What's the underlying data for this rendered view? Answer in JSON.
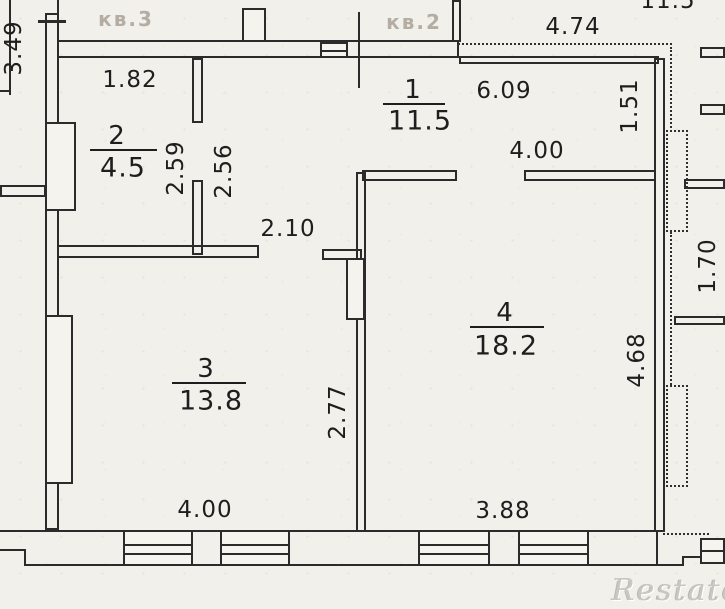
{
  "rooms": [
    {
      "number": "1",
      "area": "11.5"
    },
    {
      "number": "2",
      "area": "4.5"
    },
    {
      "number": "3",
      "area": "13.8"
    },
    {
      "number": "4",
      "area": "18.2"
    }
  ],
  "dimensions": {
    "room2_top_width": "1.82",
    "room2_height_left": "2.59",
    "room2_height_right": "2.56",
    "hall_opening_width": "2.10",
    "hall_top_width": "6.09",
    "room4_top_width": "4.00",
    "room3_right_height": "2.77",
    "room3_bottom_width": "4.00",
    "room4_bottom_width": "3.88",
    "room4_right_height": "4.68",
    "balcony_top_width": "4.74",
    "right_top_height": "1.51",
    "right_balcony_height": "1.70",
    "left_edge_height": "3.49",
    "top_right_partial": "11.5"
  },
  "stamps": {
    "apartment_left": "кв.3",
    "apartment_right": "кв.2"
  },
  "watermark": "Restate",
  "colors": {
    "paper": "#f2f0ea",
    "ink": "#2b2b2b",
    "faded_stamp": "#b3ada3",
    "watermark": "#c9c7c2"
  }
}
